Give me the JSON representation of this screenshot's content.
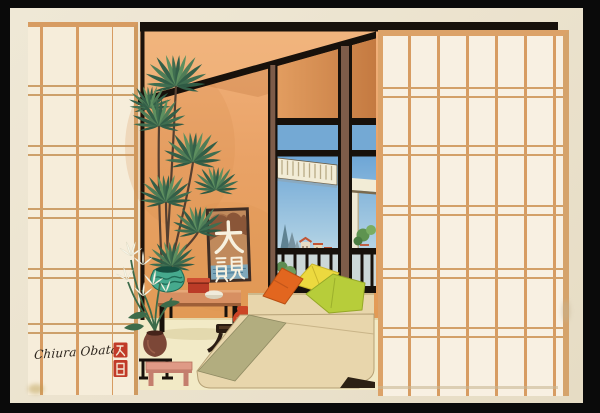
{
  "print": {
    "artist_signature": "Chiura Obata",
    "seal": "red artist seal",
    "wall_panel_text": "大観",
    "palette": {
      "photo_background": "#0a0a0a",
      "card_paper": "#ebe2cd",
      "shoji_paper": "#f6edda",
      "shoji_lattice": "#d79c62",
      "wall_orange": "#e9a266",
      "beam_black": "#17110b",
      "window_post_brown": "#7d5c49",
      "sky_blue": "#6ea6d6",
      "plant_green": "#4f7d57",
      "vase_teal": "#46a98d",
      "table_salmon": "#d78f62",
      "sofa_cream": "#e8d6ac",
      "cushion_sage": "#b2ad7f",
      "pillow_orange": "#e2661f",
      "pillow_yellow": "#ecd93f",
      "pillow_green": "#b7cd3a",
      "accent_red": "#c13a28",
      "floor_cream": "#f2eac6"
    }
  }
}
